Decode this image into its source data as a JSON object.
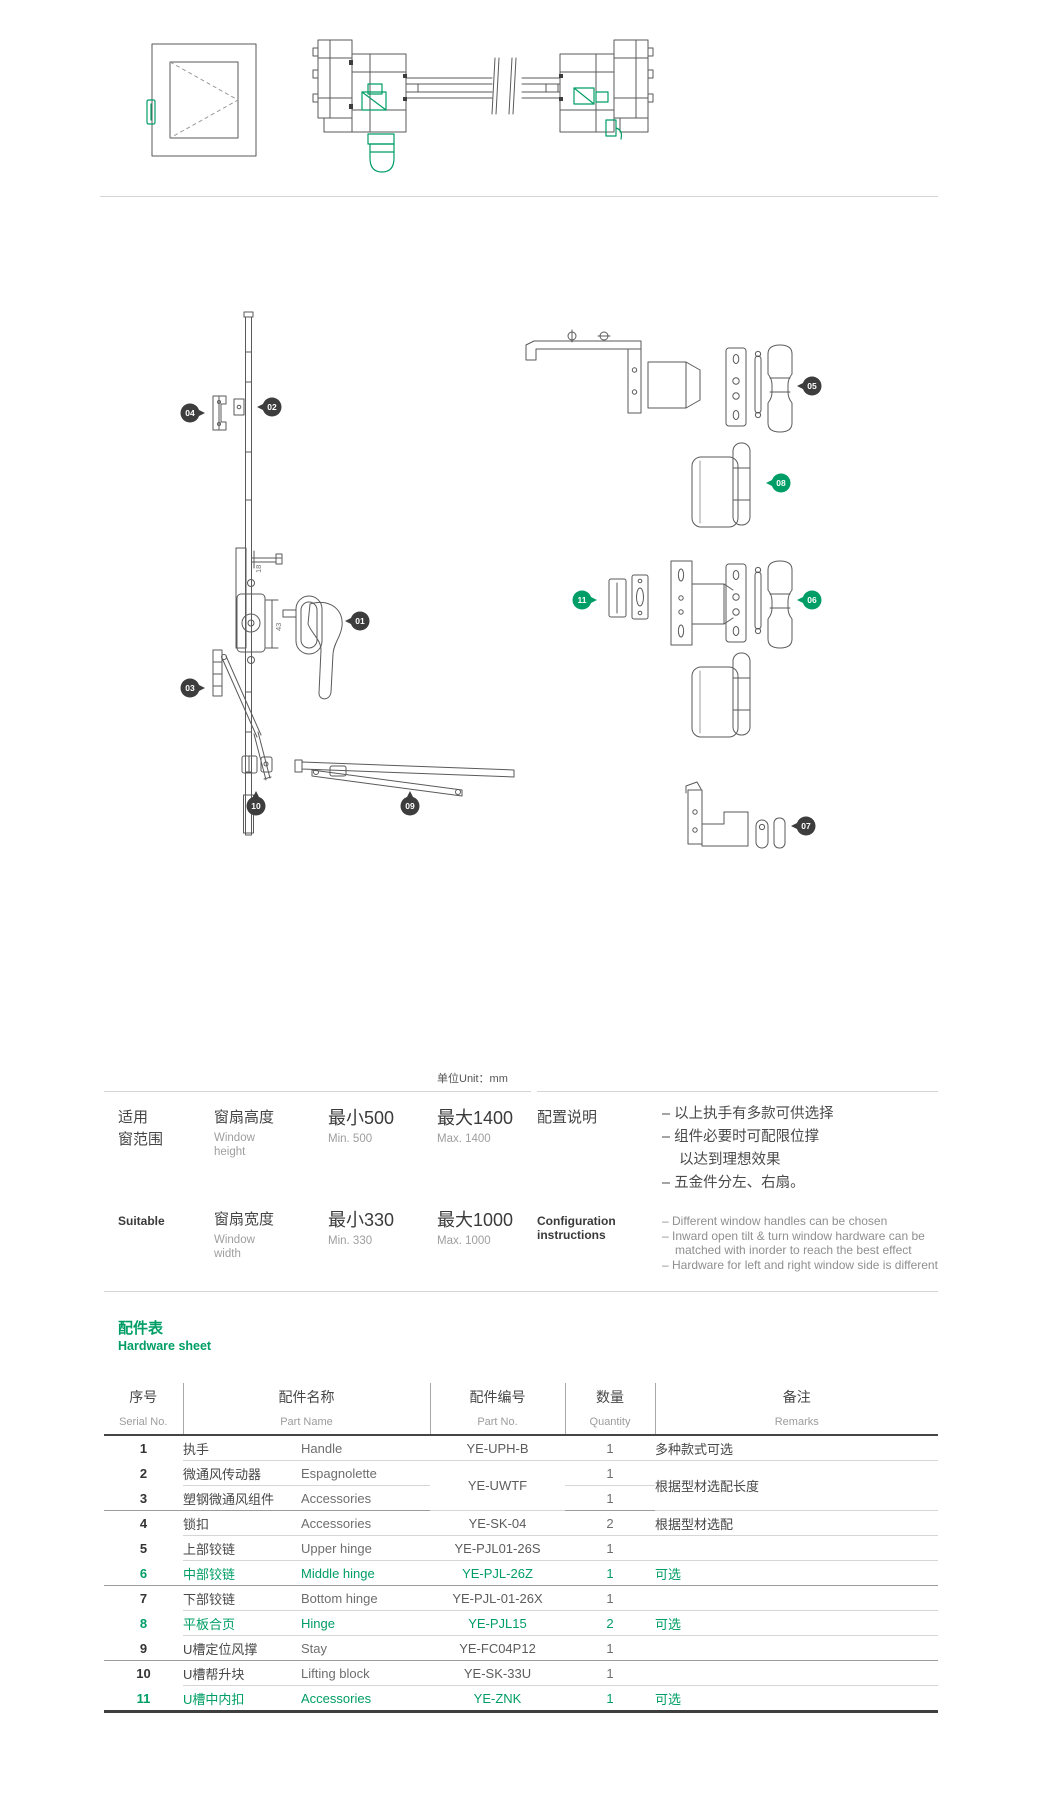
{
  "colors": {
    "accent": "#009e66"
  },
  "diagram": {
    "unit_label": "单位Unit：mm",
    "dims": {
      "d18": "18",
      "d43": "43"
    },
    "callouts": [
      "01",
      "02",
      "03",
      "04",
      "05",
      "06",
      "07",
      "08",
      "09",
      "10",
      "11"
    ]
  },
  "spec": {
    "rows": [
      {
        "group_line1": "适用",
        "group_line2": "窗范围",
        "param_cn": "窗扇高度",
        "param_en_l1": "Window",
        "param_en_l2": "height",
        "min_cn": "最小500",
        "min_en": "Min. 500",
        "max_cn": "最大1400",
        "max_en": "Max. 1400"
      },
      {
        "group_line1": "Suitable",
        "param_cn": "窗扇宽度",
        "param_en_l1": "Window",
        "param_en_l2": "width",
        "min_cn": "最小330",
        "min_en": "Min. 330",
        "max_cn": "最大1000",
        "max_en": "Max. 1000"
      }
    ],
    "config": {
      "title_cn": "配置说明",
      "title_en_l1": "Configuration",
      "title_en_l2": "instructions",
      "bullets_cn": [
        "– 以上执手有多款可供选择",
        "– 组件必要时可配限位撑",
        "以达到理想效果",
        "– 五金件分左、右扇。"
      ],
      "bullets_en": [
        "– Different window handles can be chosen",
        "– Inward open tilt & turn window hardware can be",
        "matched with inorder to reach the best effect",
        "– Hardware for left and right window side is different"
      ]
    }
  },
  "hardware": {
    "title_cn": "配件表",
    "title_en": "Hardware sheet",
    "headers": {
      "serial_cn": "序号",
      "serial_en": "Serial No.",
      "name_cn": "配件名称",
      "name_en": "Part Name",
      "partno_cn": "配件编号",
      "partno_en": "Part No.",
      "qty_cn": "数量",
      "qty_en": "Quantity",
      "remarks_cn": "备注",
      "remarks_en": "Remarks"
    },
    "rows": [
      {
        "no": "1",
        "name_cn": "执手",
        "name_en": "Handle",
        "part_no": "YE-UPH-B",
        "qty": "1",
        "remarks": "多种款式可选"
      },
      {
        "no": "2",
        "name_cn": "微通风传动器",
        "name_en": "Espagnolette",
        "part_no": "YE-UWTF",
        "qty": "1",
        "remarks": "根据型材选配长度"
      },
      {
        "no": "3",
        "name_cn": "塑钢微通风组件",
        "name_en": "Accessories",
        "qty": "1"
      },
      {
        "no": "4",
        "name_cn": "锁扣",
        "name_en": "Accessories",
        "part_no": "YE-SK-04",
        "qty": "2",
        "remarks": "根据型材选配"
      },
      {
        "no": "5",
        "name_cn": "上部铰链",
        "name_en": "Upper hinge",
        "part_no": "YE-PJL01-26S",
        "qty": "1",
        "remarks": ""
      },
      {
        "no": "6",
        "name_cn": "中部铰链",
        "name_en": "Middle hinge",
        "part_no": "YE-PJL-26Z",
        "qty": "1",
        "remarks": "可选"
      },
      {
        "no": "7",
        "name_cn": "下部铰链",
        "name_en": "Bottom hinge",
        "part_no": "YE-PJL-01-26X",
        "qty": "1",
        "remarks": ""
      },
      {
        "no": "8",
        "name_cn": "平板合页",
        "name_en": "Hinge",
        "part_no": "YE-PJL15",
        "qty": "2",
        "remarks": "可选"
      },
      {
        "no": "9",
        "name_cn": "U槽定位风撑",
        "name_en": "Stay",
        "part_no": "YE-FC04P12",
        "qty": "1",
        "remarks": ""
      },
      {
        "no": "10",
        "name_cn": "U槽帮升块",
        "name_en": "Lifting block",
        "part_no": "YE-SK-33U",
        "qty": "1",
        "remarks": ""
      },
      {
        "no": "11",
        "name_cn": "U槽中内扣",
        "name_en": "Accessories",
        "part_no": "YE-ZNK",
        "qty": "1",
        "remarks": "可选"
      }
    ]
  }
}
